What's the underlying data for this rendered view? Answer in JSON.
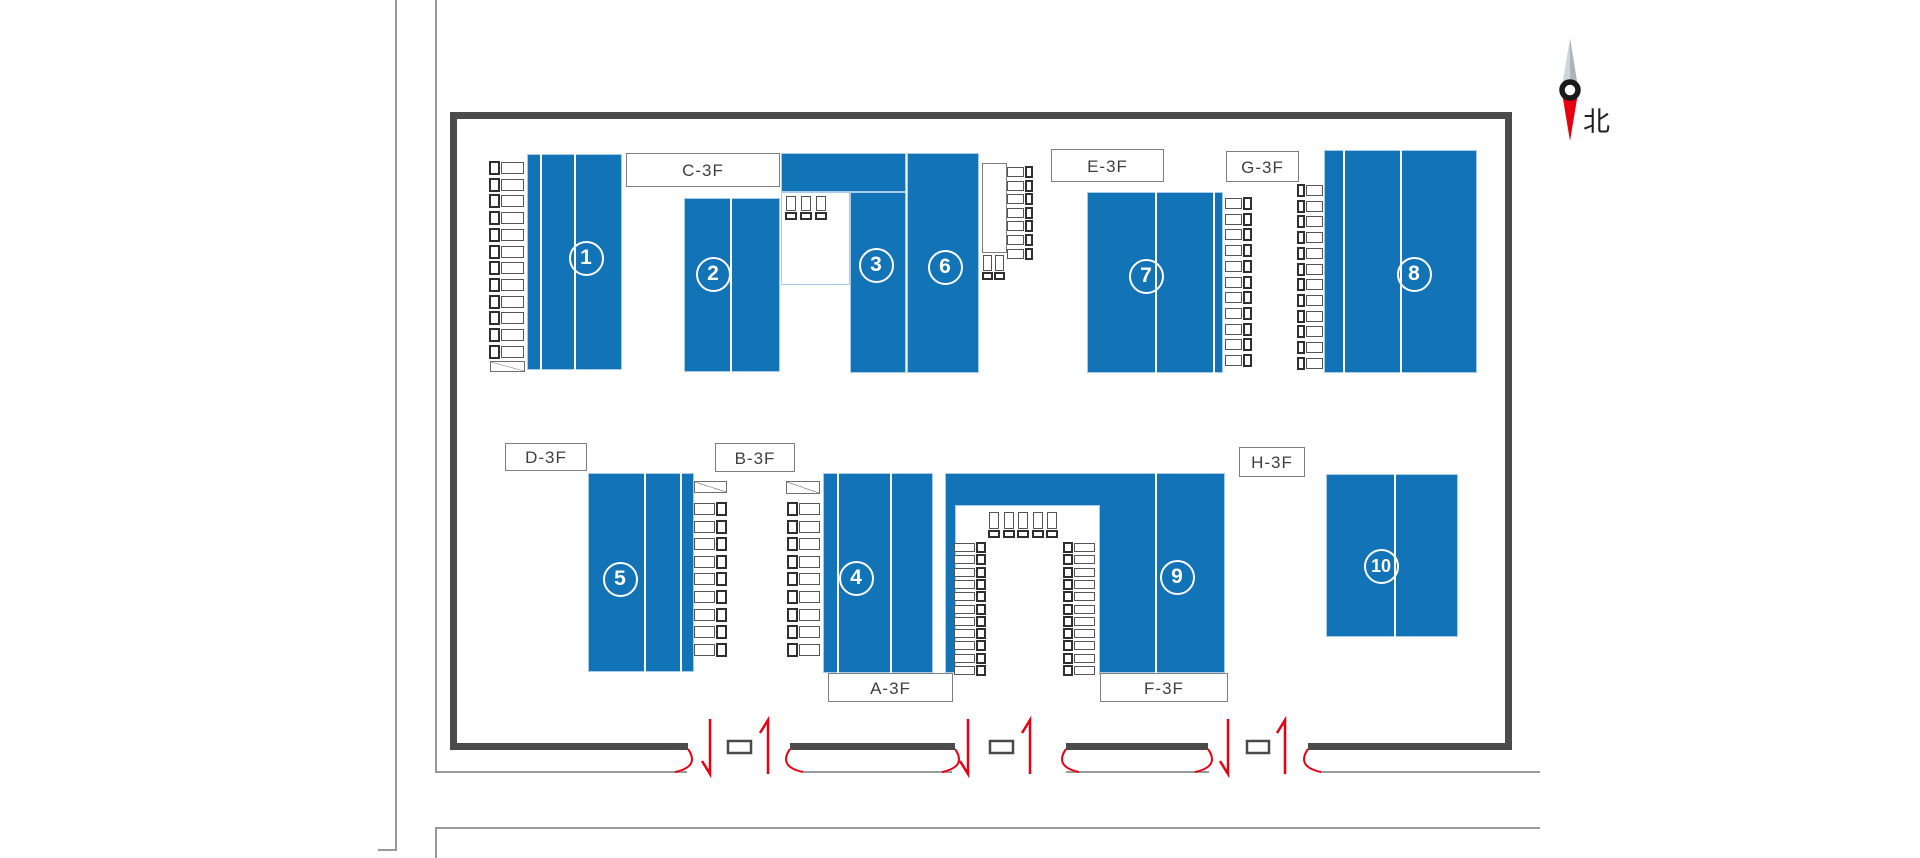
{
  "compass": {
    "label": "北",
    "cx": 1570,
    "top": 38,
    "mid": 90,
    "bottom": 141,
    "half_w": 8.5,
    "ring_r": 8
  },
  "colors": {
    "building_blue": "#1273b7",
    "building_border": "#a6cce9",
    "wall_gray": "#4b4b4b",
    "thin_line_gray": "#9a9a9a",
    "label_border": "#7e7e7e",
    "label_text": "#3f3f3f",
    "gate_red": "#e60012",
    "needle_gray_light": "#ccd5d9",
    "needle_gray_dark": "#a9b5bb",
    "needle_red": "#e60012"
  },
  "buildings": [
    {
      "id": "bldg-1",
      "number": "1",
      "rects": [
        [
          527,
          154,
          95,
          216
        ]
      ],
      "lines": [
        [
          540,
          154,
          370
        ],
        [
          574,
          154,
          370
        ]
      ],
      "badge": [
        586,
        258
      ]
    },
    {
      "id": "bldg-2",
      "number": "2",
      "rects": [
        [
          684,
          198,
          96,
          174
        ]
      ],
      "lines": [
        [
          730,
          198,
          372
        ]
      ],
      "badge": [
        713,
        274
      ]
    },
    {
      "id": "bldg-3",
      "number": "3",
      "rects": [
        [
          781,
          153,
          125,
          39
        ],
        [
          850,
          192,
          56,
          181
        ]
      ],
      "lines": [],
      "badge": [
        876,
        265
      ],
      "notch": [
        781,
        192,
        69,
        93
      ]
    },
    {
      "id": "bldg-6",
      "number": "6",
      "rects": [
        [
          907,
          153,
          72,
          220
        ]
      ],
      "lines": [],
      "badge": [
        945,
        267
      ]
    },
    {
      "id": "bldg-7",
      "number": "7",
      "rects": [
        [
          1087,
          192,
          136,
          181
        ]
      ],
      "lines": [
        [
          1155,
          192,
          373
        ],
        [
          1213,
          192,
          373
        ]
      ],
      "badge": [
        1146,
        276
      ]
    },
    {
      "id": "bldg-8",
      "number": "8",
      "rects": [
        [
          1324,
          150,
          153,
          223
        ]
      ],
      "lines": [
        [
          1343,
          150,
          373
        ],
        [
          1400,
          150,
          373
        ]
      ],
      "badge": [
        1414,
        274
      ]
    },
    {
      "id": "bldg-5",
      "number": "5",
      "rects": [
        [
          588,
          473,
          106,
          199
        ]
      ],
      "lines": [
        [
          644,
          473,
          672
        ],
        [
          680,
          473,
          672
        ]
      ],
      "badge": [
        620,
        579
      ]
    },
    {
      "id": "bldg-4",
      "number": "4",
      "rects": [
        [
          823,
          473,
          110,
          200
        ]
      ],
      "lines": [
        [
          837,
          473,
          673
        ],
        [
          890,
          473,
          673
        ]
      ],
      "badge": [
        856,
        578
      ]
    },
    {
      "id": "bldg-9",
      "number": "9",
      "rects": [
        [
          945,
          473,
          280,
          200
        ]
      ],
      "lines": [
        [
          1155,
          473,
          673
        ]
      ],
      "badge": [
        1177,
        577
      ],
      "courtyard": [
        955,
        505,
        145,
        170
      ]
    },
    {
      "id": "bldg-10",
      "number": "10",
      "rects": [
        [
          1326,
          474,
          132,
          163
        ]
      ],
      "lines": [
        [
          1394,
          474,
          637
        ]
      ],
      "badge": [
        1381,
        566
      ]
    }
  ],
  "labels": [
    {
      "id": "label-c3f",
      "text": "C-3F",
      "box": [
        626,
        153,
        154,
        34
      ]
    },
    {
      "id": "label-e3f",
      "text": "E-3F",
      "box": [
        1051,
        149,
        113,
        33
      ]
    },
    {
      "id": "label-g3f",
      "text": "G-3F",
      "box": [
        1226,
        151,
        73,
        31
      ]
    },
    {
      "id": "label-d3f",
      "text": "D-3F",
      "box": [
        505,
        443,
        82,
        28
      ]
    },
    {
      "id": "label-b3f",
      "text": "B-3F",
      "box": [
        715,
        443,
        80,
        29
      ]
    },
    {
      "id": "label-h3f",
      "text": "H-3F",
      "box": [
        1239,
        447,
        66,
        30
      ]
    },
    {
      "id": "label-a3f",
      "text": "A-3F",
      "box": [
        828,
        673,
        125,
        29
      ]
    },
    {
      "id": "label-f3f",
      "text": "F-3F",
      "box": [
        1100,
        673,
        128,
        29
      ]
    }
  ],
  "site": {
    "wall_rects": [
      [
        450,
        112,
        1062,
        7
      ],
      [
        450,
        112,
        7,
        638
      ],
      [
        1505,
        112,
        7,
        638
      ],
      [
        450,
        743,
        238,
        7
      ],
      [
        790,
        743,
        165,
        7
      ],
      [
        1066,
        743,
        142,
        7
      ],
      [
        1308,
        743,
        204,
        7
      ]
    ],
    "thin_lines": [
      [
        395,
        0,
        2,
        851
      ],
      [
        378,
        849,
        19,
        2
      ],
      [
        435,
        0,
        2,
        773
      ],
      [
        435,
        771,
        252,
        2
      ],
      [
        803,
        771,
        149,
        2
      ],
      [
        1066,
        771,
        143,
        2
      ],
      [
        1320,
        771,
        220,
        2
      ],
      [
        435,
        827,
        1105,
        2
      ],
      [
        435,
        827,
        2,
        31
      ]
    ],
    "gates": [
      {
        "id": "gate-1",
        "arc_left": 688,
        "arrow_in": 710,
        "box": [
          728,
          741,
          23,
          12
        ],
        "arrow_out": 768,
        "arc_right": 790
      },
      {
        "id": "gate-2",
        "arc_left": 955,
        "arrow_in": 968,
        "box": [
          990,
          741,
          23,
          12
        ],
        "arrow_out": 1030,
        "arc_right": 1066
      },
      {
        "id": "gate-3",
        "arc_left": 1208,
        "arrow_in": 1228,
        "box": [
          1247,
          741,
          22,
          12
        ],
        "arrow_out": 1285,
        "arc_right": 1308
      }
    ],
    "dock_office": [
      982,
      163,
      25,
      90
    ]
  },
  "trucks": {
    "h_columns": [
      {
        "id": "docks-west-of-1",
        "x": 489,
        "len": 35,
        "h": 12,
        "cab": "left",
        "y0": 162,
        "pitch": 16.7,
        "count": 12
      },
      {
        "id": "docks-east-of-5",
        "x": 694,
        "len": 33,
        "h": 12,
        "cab": "right",
        "y0": 503,
        "pitch": 17.6,
        "count": 9
      },
      {
        "id": "docks-west-of-4",
        "x": 787,
        "len": 33,
        "h": 12,
        "cab": "left",
        "y0": 503,
        "pitch": 17.6,
        "count": 9
      },
      {
        "id": "docks-east-of-6",
        "x": 1007,
        "len": 26,
        "h": 10,
        "cab": "right",
        "y0": 167,
        "pitch": 13.6,
        "count": 7
      },
      {
        "id": "docks-east-of-7",
        "x": 1225,
        "len": 27,
        "h": 11,
        "cab": "right",
        "y0": 198,
        "pitch": 15.7,
        "count": 11
      },
      {
        "id": "docks-west-of-8",
        "x": 1297,
        "len": 26,
        "h": 11,
        "cab": "left",
        "y0": 185,
        "pitch": 15.7,
        "count": 12
      },
      {
        "id": "docks-courtyard-west",
        "x": 954,
        "len": 32,
        "h": 9,
        "cab": "right",
        "y0": 543,
        "pitch": 12.3,
        "count": 11
      },
      {
        "id": "docks-courtyard-east",
        "x": 1063,
        "len": 32,
        "h": 9,
        "cab": "left",
        "y0": 543,
        "pitch": 12.3,
        "count": 11
      }
    ],
    "v_groups": [
      {
        "id": "docks-notch-top",
        "y": 196,
        "h": 24,
        "w": 10,
        "xs": [
          786,
          801,
          816
        ]
      },
      {
        "id": "docks-below-office",
        "y": 255,
        "h": 25,
        "w": 9,
        "xs": [
          983,
          995
        ]
      },
      {
        "id": "docks-courtyard-north",
        "y": 512,
        "h": 26,
        "w": 10,
        "xs": [
          989,
          1004,
          1018,
          1033,
          1047
        ]
      }
    ],
    "ramps": [
      [
        490,
        361,
        35,
        11
      ],
      [
        694,
        481,
        33,
        12
      ],
      [
        786,
        481,
        34,
        13
      ]
    ]
  }
}
